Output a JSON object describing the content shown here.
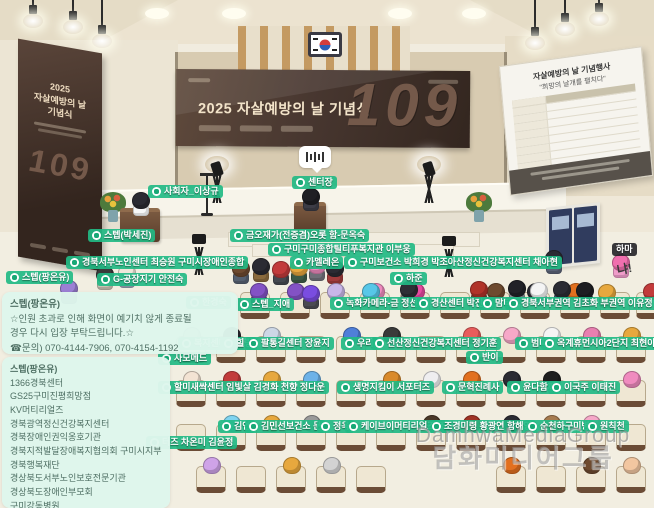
{
  "colors": {
    "accent_green": "#22ba84",
    "banner_brown": "#3a2b23",
    "notice_mint": "#def6ec",
    "floor": "#f2eee1"
  },
  "icons": {
    "tag_icon": "chat-bubble-icon",
    "flag": "korean-flag",
    "stage_bubble": "sound-level-icon",
    "board": "schedule-whiteboard",
    "door": "double-door"
  },
  "banners": {
    "main": {
      "title": "2025 자살예방의 날 기념식",
      "number": "109"
    },
    "side": {
      "line1": "2025",
      "line2": "자살예방의 날",
      "line3": "기념식",
      "number": "109"
    }
  },
  "board": {
    "title": "자살예방의 날 기념행사",
    "subtitle": "\"희망의 날개를 펼치다\"",
    "row_count": 10
  },
  "watermark": {
    "latin": "DamhwaMediaGroup",
    "korean": "담화미디어그룹"
  },
  "chat_notices": [
    {
      "header": "스텝(팡온유)",
      "lines": [
        "☆인원 초과로 인해 화면이 예기치 않게 종료될",
        "경우 다시 입장 부탁드립니다.☆",
        "☎문의) 070-4144-7906, 070-4154-1192"
      ]
    },
    {
      "header": "스텝(팡온유)",
      "lines": [
        "1366경북센터",
        "GS25구미진평희망점",
        "KV머티리얼즈",
        "경북광역정신건강복지센터",
        "경북장애인권익옹호기관",
        "경북지적발달장애복지협의회 구미시지부",
        "경북행복재단",
        "경상북도서부노인보호전문기관",
        "경상북도장애인부모회",
        "구미강동병원..."
      ]
    }
  ],
  "name_tags": [
    {
      "text": "사회자_이상규",
      "x": 148,
      "y": 185
    },
    {
      "text": "센터장",
      "x": 292,
      "y": 176
    },
    {
      "text": "스텝(박세진)",
      "x": 88,
      "y": 229
    },
    {
      "text": "금오재가(전증겸)오롯 함-문옥숙",
      "x": 230,
      "y": 229
    },
    {
      "text": "구미구미종합틸티푸복지관 이부웅",
      "x": 268,
      "y": 243
    },
    {
      "text": "경북서부노인센터 최승원 구미시장애인종합",
      "x": 66,
      "y": 256
    },
    {
      "text": "카멜레온",
      "x": 290,
      "y": 256
    },
    {
      "text": "스텝(팡온유)",
      "x": 6,
      "y": 271
    },
    {
      "text": "G-공장지기 안전숙",
      "x": 97,
      "y": 273
    },
    {
      "text": "구미보건소 박희경 박조아산정신건강복지센터 채아현",
      "x": 344,
      "y": 256
    },
    {
      "text": "하준",
      "x": 390,
      "y": 272
    },
    {
      "text": "하마",
      "x": 612,
      "y": 243,
      "style": "dark"
    },
    {
      "text": "냐!",
      "x": 613,
      "y": 263,
      "style": "plain"
    },
    {
      "text": "한경숙",
      "x": 186,
      "y": 296
    },
    {
      "text": "스텝_지애",
      "x": 236,
      "y": 298
    },
    {
      "text": "녹화카메라-금 정선",
      "x": 330,
      "y": 297
    },
    {
      "text": "경산센터 박진아",
      "x": 415,
      "y": 297
    },
    {
      "text": "맘티",
      "x": 479,
      "y": 297
    },
    {
      "text": "경북서부권역 김초화 부권역 이유정",
      "x": 505,
      "y": 297
    },
    {
      "text": "복지센터",
      "x": 178,
      "y": 337
    },
    {
      "text": "힐링",
      "x": 220,
      "y": 337
    },
    {
      "text": "팔통길센터 장윤지",
      "x": 245,
      "y": 337
    },
    {
      "text": "우리",
      "x": 341,
      "y": 337
    },
    {
      "text": "선산정신건강복지센터 정기훈",
      "x": 371,
      "y": 337
    },
    {
      "text": "범띠",
      "x": 515,
      "y": 337
    },
    {
      "text": "옥계휴먼시아2단지 최현아",
      "x": 541,
      "y": 337
    },
    {
      "text": "사모메드",
      "x": 158,
      "y": 352
    },
    {
      "text": "반이",
      "x": 466,
      "y": 351
    },
    {
      "text": "할미새싹센터 임빛살 김경화 천향 정다운",
      "x": 158,
      "y": 381
    },
    {
      "text": "생명지킴이 서포터즈",
      "x": 337,
      "y": 381
    },
    {
      "text": "문혁진례사",
      "x": 442,
      "y": 381
    },
    {
      "text": "윤다함께",
      "x": 507,
      "y": 381
    },
    {
      "text": "이국주 이태진",
      "x": 548,
      "y": 381
    },
    {
      "text": "김연",
      "x": 218,
      "y": 420
    },
    {
      "text": "김민선보건소 문",
      "x": 245,
      "y": 420
    },
    {
      "text": "정욱",
      "x": 317,
      "y": 420
    },
    {
      "text": "케이브이머티리얼즈 조",
      "x": 345,
      "y": 420
    },
    {
      "text": "조경미령 황광연 함해영",
      "x": 428,
      "y": 420
    },
    {
      "text": "순천하구미병",
      "x": 524,
      "y": 420
    },
    {
      "text": "원칙천",
      "x": 584,
      "y": 420
    },
    {
      "text": "터즈 차온미 김윤정",
      "x": 146,
      "y": 436
    }
  ],
  "audience": {
    "rows": [
      {
        "y": 292,
        "xs": [
          240,
          280,
          320,
          360,
          400,
          440,
          480,
          520,
          560,
          600,
          636
        ],
        "heads": [
          null,
          "#8352c5",
          "#c8b6e8",
          "#f08bbf",
          "#e649a0",
          null,
          "#6e4a2f",
          "#2b2b33",
          "#e2701f",
          null,
          "#c23b3b"
        ]
      },
      {
        "y": 336,
        "xs": [
          176,
          216,
          256,
          296,
          336,
          376,
          416,
          456,
          496,
          536,
          576,
          616
        ],
        "heads": [
          "#d9d2c2",
          "#2b2b33",
          "#cdd7e6",
          null,
          "#4f7fd9",
          "#3a3a3a",
          null,
          "#e85c5c",
          "#f6a8c8",
          "#f4f4f4",
          "#e87fb0",
          "#e7a83e"
        ]
      },
      {
        "y": 380,
        "xs": [
          176,
          216,
          256,
          296,
          336,
          376,
          416,
          456,
          496,
          536,
          576,
          616
        ],
        "heads": [
          "#f3e3d3",
          "#c23b3b",
          "#e7a83e",
          "#6db2e8",
          null,
          "#d98a2b",
          "#efeef0",
          "#e2701f",
          "#2b2b33",
          "#1f1f1f",
          null,
          "#f08bbf"
        ]
      },
      {
        "y": 424,
        "xs": [
          176,
          216,
          256,
          296,
          336,
          376,
          416,
          456,
          496,
          536,
          576,
          616
        ],
        "heads": [
          null,
          "#7fd4f0",
          "#e7a83e",
          "#9a9a9a",
          null,
          null,
          "#4a3828",
          "#a03325",
          "#2b2b33",
          "#a67b4f",
          "#f6a8c8",
          null
        ]
      },
      {
        "y": 466,
        "xs": [
          196,
          236,
          276,
          316,
          356,
          496,
          536,
          576,
          616
        ],
        "heads": [
          "#cfa3e8",
          null,
          "#e7a83e",
          "#d3d3d3",
          null,
          "#e2701f",
          null,
          "#6e4a2f",
          "#f2c6a0"
        ]
      }
    ]
  },
  "standing": [
    [
      96,
      266,
      "#3a3a3a",
      "#c8c2b2"
    ],
    [
      118,
      264,
      "#efe7da",
      "#9aa6b8"
    ],
    [
      60,
      280,
      "#9c7fd4",
      "#666a72"
    ],
    [
      232,
      260,
      "#6e4a2f",
      "#556070"
    ],
    [
      252,
      258,
      "#2b2b33",
      "#8a6a3c"
    ],
    [
      272,
      261,
      "#c23b3b",
      "#44484f"
    ],
    [
      290,
      259,
      "#e7a83e",
      "#3c5a46"
    ],
    [
      308,
      257,
      "#f08bbf",
      "#6f6f78"
    ],
    [
      326,
      260,
      "#2b2b33",
      "#a03b3b"
    ],
    [
      250,
      283,
      "#8352c5",
      "#3a3a44"
    ],
    [
      302,
      285,
      "#7a4de0",
      "#4a4a52"
    ],
    [
      362,
      283,
      "#57c7e8",
      "#5c6068"
    ],
    [
      400,
      281,
      "#2f2f36",
      "#7d8289"
    ],
    [
      470,
      281,
      "#b03329",
      "#5a4a3a"
    ],
    [
      508,
      280,
      "#222228",
      "#8a8f96"
    ],
    [
      530,
      282,
      "#f4f4f4",
      "#7289a6"
    ],
    [
      553,
      281,
      "#2b2b33",
      "#46506a"
    ],
    [
      576,
      282,
      "#1e1e22",
      "#33363c"
    ],
    [
      598,
      284,
      "#e7a83e",
      "#96643c"
    ],
    [
      612,
      254,
      "#f06fae",
      "#ef9cc9"
    ],
    [
      545,
      250,
      "#2b2b33",
      "#5a6276"
    ]
  ]
}
